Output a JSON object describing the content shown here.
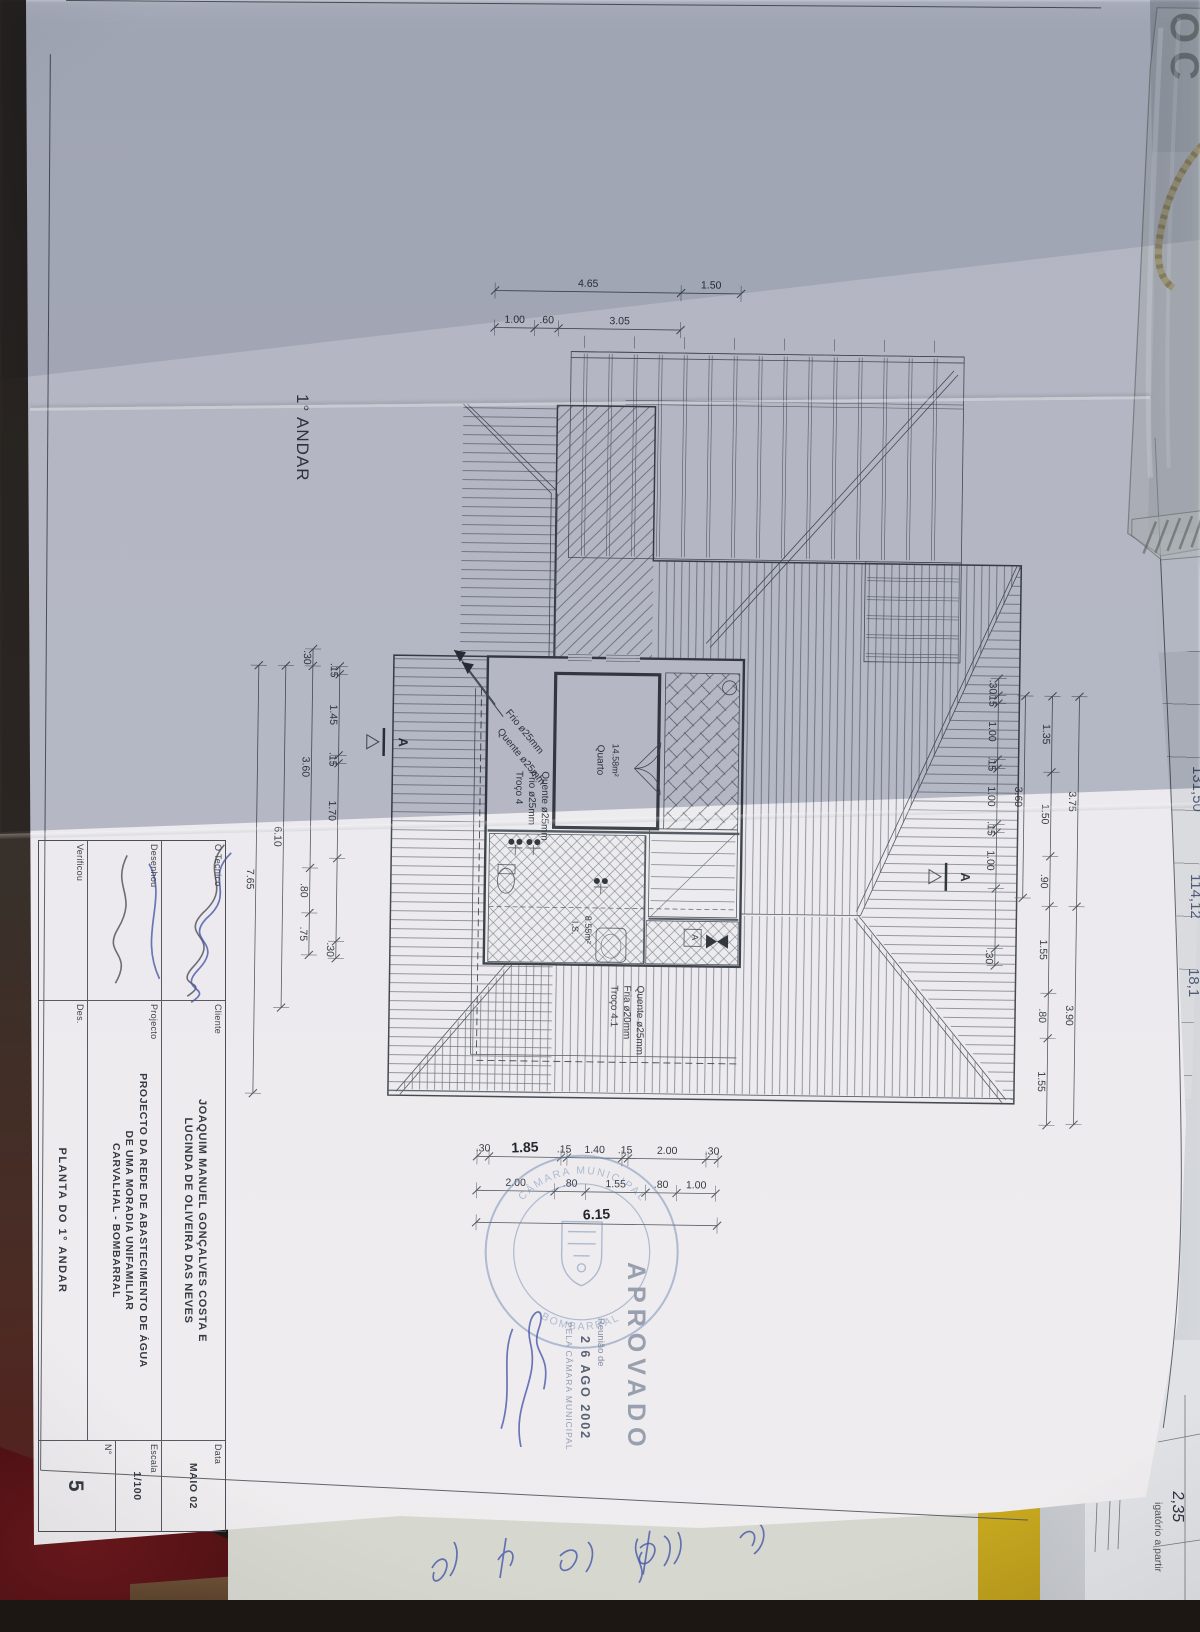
{
  "drawing": {
    "floor_label": "1° ANDAR",
    "room_quarto": {
      "name": "Quarto",
      "area": "14.58m²"
    },
    "room_is": {
      "name": "I.S.",
      "area": "8.55m²"
    },
    "pipe_frio": "Frio ø25mm",
    "pipe_quente": "Quente ø25mm",
    "troco4": {
      "l1": "Troço 4",
      "l2": "Frio ø25mm",
      "l3": "Quente ø25mm"
    },
    "troco41": {
      "l1": "Troço 4.1",
      "l2": "Fria ø20mm",
      "l3": "Quente ø25mm"
    },
    "section_marker": "A",
    "meter_box_label": "A",
    "dims": {
      "top_outer": [
        "4.65",
        "1.50"
      ],
      "top_inner": [
        "1.00",
        ".60",
        "3.05"
      ],
      "left_c1": [
        ".30",
        "3.60",
        ".80",
        ".75"
      ],
      "left_c2": [
        "6.10"
      ],
      "left_c3": [
        "7.65"
      ],
      "left_inner": [
        ".15",
        "1.45",
        ".15",
        "1.70",
        "",
        ".30"
      ],
      "right_c1": [
        "3.75",
        "3.90"
      ],
      "right_c2": [
        "1.35",
        "1.50",
        ".90",
        "1.55",
        ".80",
        "1.55"
      ],
      "right_c3": [
        "3.60"
      ],
      "right_inner": [
        ".30",
        ".15",
        "1.00",
        ".15",
        "1.00",
        ".15",
        "1.00",
        "",
        ".30"
      ],
      "bottom_chain1": [
        ".30",
        "1.85",
        ".15",
        "1.40",
        ".15",
        "2.00",
        ".30"
      ],
      "bottom_chain2": [
        "2.00",
        ".80",
        "1.55",
        ".80",
        "1.00"
      ],
      "bottom_total": [
        "6.15"
      ]
    }
  },
  "title_block": {
    "tecnico_label": "O Tecnico",
    "desenhou_label": "Desenhou",
    "verificou_label": "Verificou",
    "cliente_label": "Cliente",
    "cliente_lines": [
      "JOAQUIM MANUEL GONÇALVES COSTA E",
      "LUCINDA DE OLIVEIRA DAS NEVES"
    ],
    "projecto_label": "Projecto",
    "projecto_lines": [
      "PROJECTO DA REDE DE ABASTECIMENTO DE ÁGUA",
      "DE UMA MORADIA UNIFAMILIAR",
      "CARVALHAL - BOMBARRAL"
    ],
    "des_label": "Des.",
    "des_value": "PLANTA DO 1° ANDAR",
    "data_label": "Data",
    "data_value": "MAIO 02",
    "escala_label": "Escala",
    "escala_value": "1/100",
    "numero_label": "N°",
    "numero_value": "5"
  },
  "stamps": {
    "aprovado": "APROVADO",
    "reuniao": "Reunião de",
    "date": "2 6 AGO 2002",
    "pela": "PELA CÂMARA MUNICIPAL",
    "ring_top": "CÂMARA MUNICIPAL",
    "ring_bottom": "BOMBARRAL"
  },
  "annotations": {
    "oc_fragment": "OC",
    "right_margin_values": [
      "131,50",
      "114,12",
      "18,1"
    ],
    "cell_value": "2,35",
    "partial_print": "igatório a partir"
  },
  "colors": {
    "stamp_blue": "#5f7fae",
    "signature_blue": "#4757a8",
    "folder_yellow": "#d8b92c",
    "cloth_red": "#611418",
    "wood_brown": "#7d5c3e",
    "paper_lit": "#ecebee",
    "paper_shadow": "#b6bac3"
  }
}
